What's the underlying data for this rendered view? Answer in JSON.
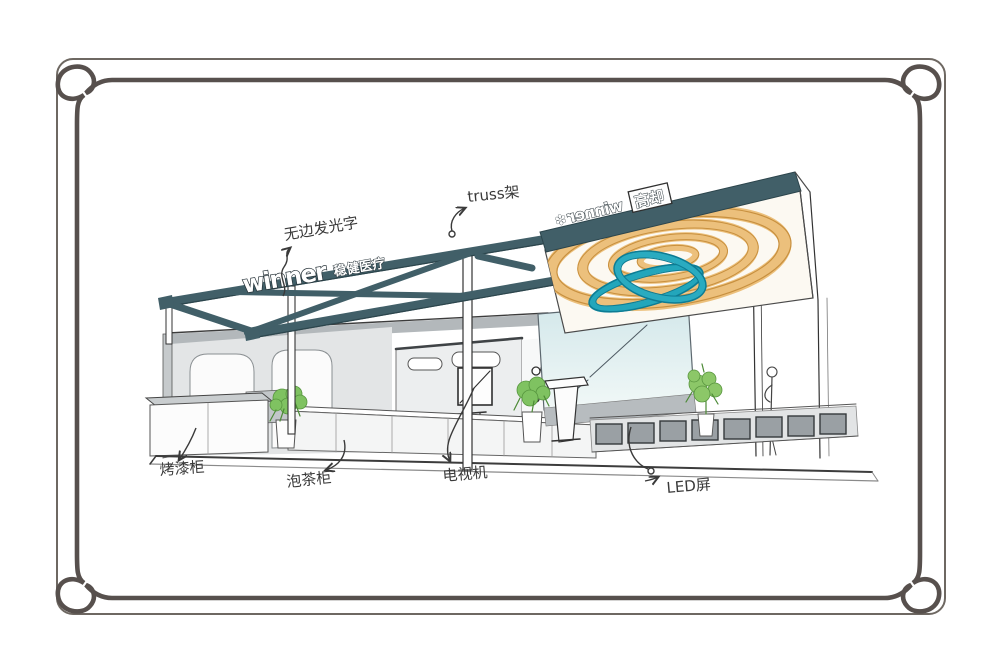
{
  "sketch": {
    "signs": {
      "front": {
        "logo": "winner",
        "brand_cn": "稳健医疗"
      },
      "back": {
        "logo_mirrored": "winner",
        "boxed_label": "高却",
        "flower_icon": "✽"
      }
    },
    "annotations": [
      {
        "id": "edge-lit-letters",
        "text": "无边发光字"
      },
      {
        "id": "truss-frame",
        "text": "truss架"
      },
      {
        "id": "paint-cabinet",
        "text": "烤漆柜"
      },
      {
        "id": "tea-cabinet",
        "text": "泡茶柜"
      },
      {
        "id": "tv-set",
        "text": "电视机"
      },
      {
        "id": "led-screen",
        "text": "LED屏"
      }
    ],
    "colors": {
      "frame_border": "#57504d",
      "outer_border": "#6e6862",
      "canopy_teal": "#415f68",
      "ring_orange": "#ecc07c",
      "ring_outline": "#c8903f",
      "ribbon_teal": "#23a6bb",
      "plant_green": "#7fc261",
      "ink": "#3a3a3a"
    }
  }
}
